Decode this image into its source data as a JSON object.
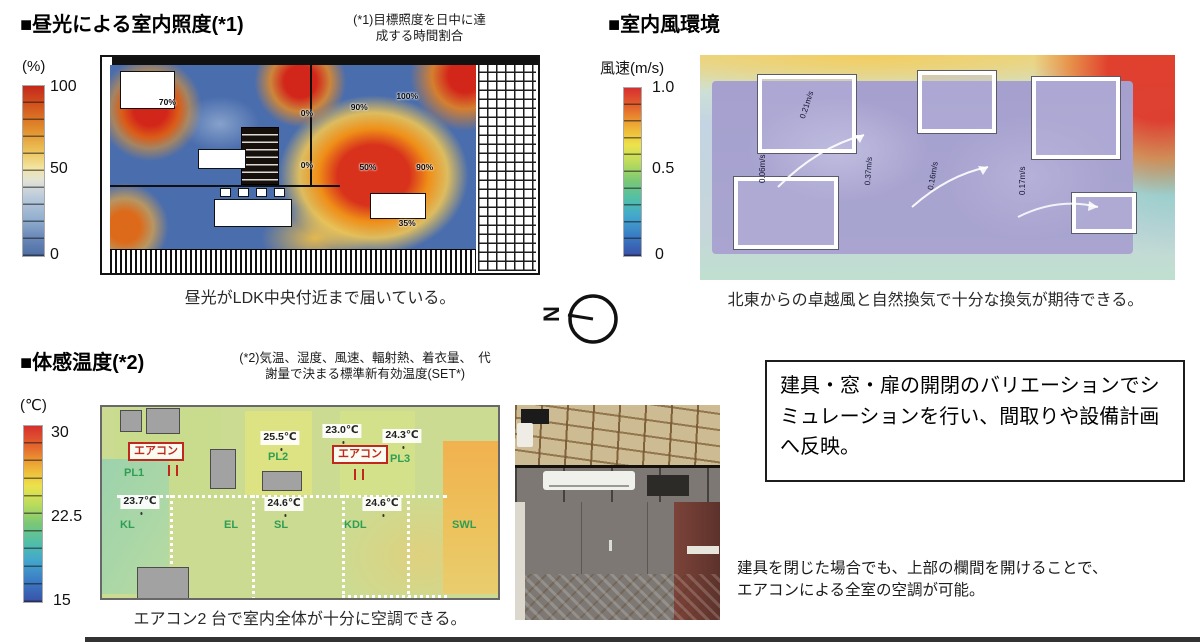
{
  "daylight": {
    "title": "■昼光による室内照度(*1)",
    "note": [
      "(*1)目標照度を日中に達",
      "成する時間割合"
    ],
    "legend_unit": "(%)",
    "legend_ticks": [
      "100",
      "50",
      "0"
    ],
    "map_labels": [
      {
        "text": "70%"
      },
      {
        "text": "0%"
      },
      {
        "text": "0%"
      },
      {
        "text": "90%"
      },
      {
        "text": "100%"
      },
      {
        "text": "50%"
      },
      {
        "text": "90%"
      },
      {
        "text": "35%"
      }
    ],
    "caption": "昼光がLDK中央付近まで届いている。"
  },
  "wind": {
    "title": "■室内風環境",
    "legend_unit": "風速(m/s)",
    "legend_ticks": [
      "1.0",
      "0.5",
      "0"
    ],
    "map_labels": [
      {
        "text": "0.21m/s"
      },
      {
        "text": "0.06m/s"
      },
      {
        "text": "0.37m/s"
      },
      {
        "text": "0.16m/s"
      },
      {
        "text": "0.17m/s"
      }
    ],
    "caption": "北東からの卓越風と自然換気で十分な換気が期待できる。"
  },
  "compass": {
    "north_letter": "N"
  },
  "temperature": {
    "title": "■体感温度(*2)",
    "note": [
      "(*2)気温、湿度、風速、輻射熱、着衣量、　代",
      "謝量で決まる標準新有効温度(SET*)"
    ],
    "legend_unit": "(℃)",
    "legend_ticks": [
      "30",
      "22.5",
      "15"
    ],
    "aircon_labels": [
      {
        "text": "エアコン"
      },
      {
        "text": "エアコン"
      }
    ],
    "room_labels": [
      {
        "text": "PL1"
      },
      {
        "text": "PL2"
      },
      {
        "text": "PL3"
      },
      {
        "text": "KL"
      },
      {
        "text": "EL"
      },
      {
        "text": "SL"
      },
      {
        "text": "KDL"
      },
      {
        "text": "SWL"
      }
    ],
    "temp_labels": [
      {
        "text": "23.7℃"
      },
      {
        "text": "25.5℃"
      },
      {
        "text": "23.0℃"
      },
      {
        "text": "24.3℃"
      },
      {
        "text": "24.6℃"
      },
      {
        "text": "24.6℃"
      }
    ],
    "caption": "エアコン2 台で室内全体が十分に空調できる。"
  },
  "callout": {
    "box_text": "建具・窓・扉の開閉のバリエーションでシミュレーションを行い、間取りや設備計画へ反映。",
    "note": [
      "建具を閉じた場合でも、上部の欄間を開けることで、",
      "エアコンによる全室の空調が可能。"
    ]
  },
  "colors": {
    "accent_red": "#c0281e",
    "room_label_green": "#2f9e55",
    "heat_blue": "#4a6dad",
    "wind_lavender": "#a5a0ce"
  }
}
